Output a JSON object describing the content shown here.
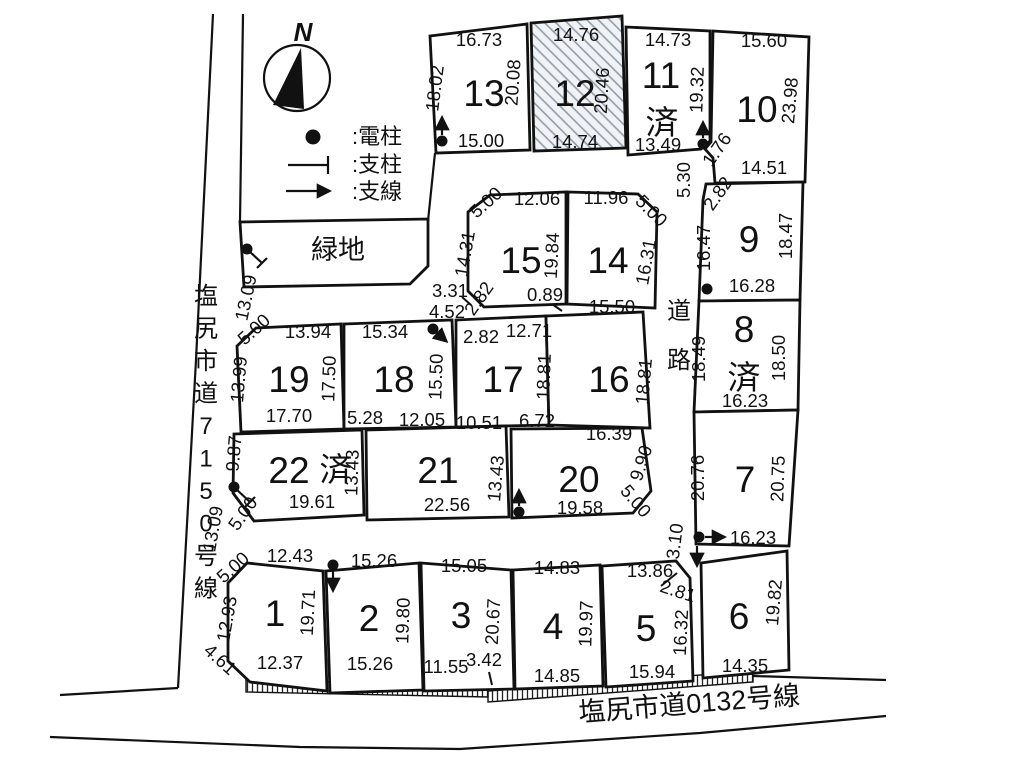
{
  "map": {
    "compass": {
      "label": "N"
    },
    "legend": {
      "pole_label": ":電柱",
      "strut_label": ":支柱",
      "wire_label": ":支線"
    },
    "roads": {
      "left": "塩尻市道7150号線",
      "bottom": "塩尻市道0132号線",
      "inner": "道路"
    },
    "green_space": "緑地",
    "sold_mark": "済",
    "lots": {
      "1": {
        "number": "1",
        "dims": {
          "top": "12.43",
          "top_left_cut": "5.00",
          "left": "12.93",
          "right": "19.71",
          "bottom": "12.37",
          "bottom_left_cut": "4.61"
        }
      },
      "2": {
        "number": "2",
        "dims": {
          "top": "15.26",
          "right": "19.80",
          "bottom": "15.26"
        }
      },
      "3": {
        "number": "3",
        "dims": {
          "top": "15.05",
          "right": "20.67",
          "bottom": "11.55",
          "bottom_right": "3.42"
        }
      },
      "4": {
        "number": "4",
        "dims": {
          "top": "14.83",
          "right": "19.97",
          "bottom": "14.85"
        }
      },
      "5": {
        "number": "5",
        "dims": {
          "top": "13.86",
          "top_right_cut": "2.81",
          "right": "16.32",
          "bottom": "15.94"
        }
      },
      "6": {
        "number": "6",
        "dims": {
          "right": "19.82",
          "bottom": "14.35"
        }
      },
      "7": {
        "number": "7",
        "dims": {
          "left": "20.76",
          "right": "20.75",
          "frontage": "16.23"
        }
      },
      "8": {
        "number": "8",
        "sold": true,
        "dims": {
          "left": "18.49",
          "right": "18.50",
          "bottom": "16.23"
        }
      },
      "9": {
        "number": "9",
        "dims": {
          "left": "16.47",
          "right": "18.47",
          "bottom": "16.28"
        }
      },
      "10": {
        "number": "10",
        "dims": {
          "top": "15.60",
          "right": "23.98",
          "bottom": "14.51"
        }
      },
      "11": {
        "number": "11",
        "sold": true,
        "dims": {
          "top": "14.73",
          "right": "19.32",
          "bottom": "13.49"
        }
      },
      "12": {
        "number": "12",
        "hatched": true,
        "dims": {
          "top": "14.76",
          "right": "20.46",
          "bottom": "14.74"
        }
      },
      "13": {
        "number": "13",
        "dims": {
          "top": "16.73",
          "left": "18.02",
          "right": "20.08",
          "bottom": "15.00"
        }
      },
      "14": {
        "number": "14",
        "dims": {
          "top": "11.96",
          "top_right_cut": "5.00",
          "right": "16.31",
          "bottom": "15.50"
        }
      },
      "15": {
        "number": "15",
        "dims": {
          "top_left_cut": "5.00",
          "top": "12.06",
          "left": "14.31",
          "right": "19.84",
          "bottom_left_cut": "2.82",
          "bottom_step": "0.89"
        }
      },
      "16": {
        "number": "16",
        "dims": {
          "right": "18.81",
          "bottom": "16.39"
        }
      },
      "17": {
        "number": "17",
        "dims": {
          "top": "12.71",
          "right": "18.81",
          "bottom": "10.51",
          "bottom2": "6.72"
        }
      },
      "18": {
        "number": "18",
        "dims": {
          "top": "15.34",
          "right": "15.50",
          "bottom": "5.28",
          "bottom2": "12.05"
        }
      },
      "19": {
        "number": "19",
        "dims": {
          "top_left_cut": "5.00",
          "top": "13.94",
          "left": "13.99",
          "right": "17.50",
          "bottom": "17.70"
        }
      },
      "20": {
        "number": "20",
        "dims": {
          "right": "9.90",
          "bottom_right_cut": "5.00",
          "bottom": "19.58"
        }
      },
      "21": {
        "number": "21",
        "dims": {
          "right": "13.43",
          "bottom": "22.56"
        }
      },
      "22": {
        "number": "22",
        "sold": true,
        "dims": {
          "left": "9.87",
          "right": "13.43",
          "bottom": "19.61",
          "bottom_left_cut": "5.00"
        }
      }
    },
    "road_measurements": {
      "left_road_upper": "13.09",
      "left_road_lower": "13.09",
      "north_mouth": "5.30",
      "corner_176": "1.76",
      "lot9_corner": "2.82",
      "stub_length": "3.31",
      "stub_width": "4.52",
      "guy_wire": "2.82",
      "south_mouth": "3.10"
    }
  }
}
